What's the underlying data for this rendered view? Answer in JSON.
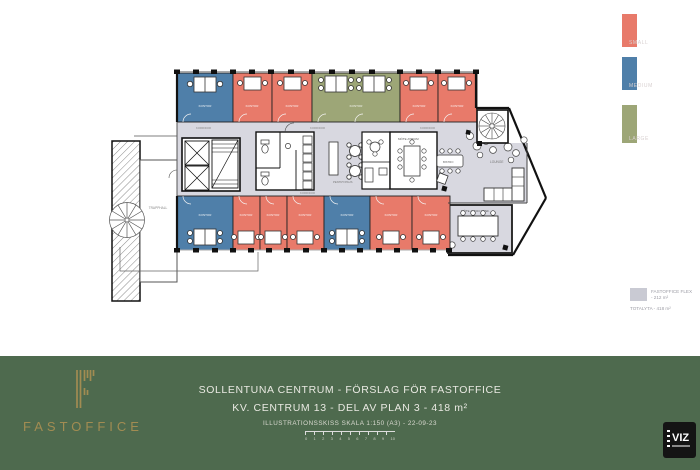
{
  "legend": {
    "items": [
      {
        "label": "SMALL",
        "color": "#E87A6A"
      },
      {
        "label": "MEDIUM",
        "color": "#4F7FA9"
      },
      {
        "label": "LARGE",
        "color": "#9DA677"
      }
    ]
  },
  "flex": {
    "label1": "FASTOFFICE FLEX",
    "label2": "- 212 m²",
    "total": "TOTALYTA - 418 m²",
    "swatch_color": "#C9CAD3"
  },
  "footer": {
    "brand": "FASTOFFICE",
    "line1": "SOLLENTUNA CENTRUM - FÖRSLAG FÖR FASTOFFICE",
    "line2": "KV. CENTRUM 13 - DEL AV PLAN 3 - 418 m²",
    "line3": "ILLUSTRATIONSSKISS SKALA 1:150 (A3) - 22-09-23",
    "scale_ticks": [
      "0",
      "1",
      "2",
      "3",
      "4",
      "5",
      "6",
      "7",
      "8",
      "9",
      "10"
    ],
    "viz": "VIZ",
    "bg_color": "#4E6A4E",
    "gold": "#A28C52"
  },
  "plan": {
    "labels": {
      "kontor": "KONTOR",
      "korridor": "KORRIDOR",
      "trapphall": "TRAPPHALL",
      "lounge": "LOUNGE",
      "bistro": "BISTRO",
      "pentry": "PENTRY/PAUS",
      "mote_atrium": "MÖTE ATRIUM",
      "mote_konf": "MÖTE AUDIO KONF."
    },
    "colors": {
      "small": "#E87A6A",
      "medium": "#4F7FA9",
      "large": "#9DA677",
      "common_area": "#D8D8E0",
      "wall": "#1B1B1B"
    }
  }
}
